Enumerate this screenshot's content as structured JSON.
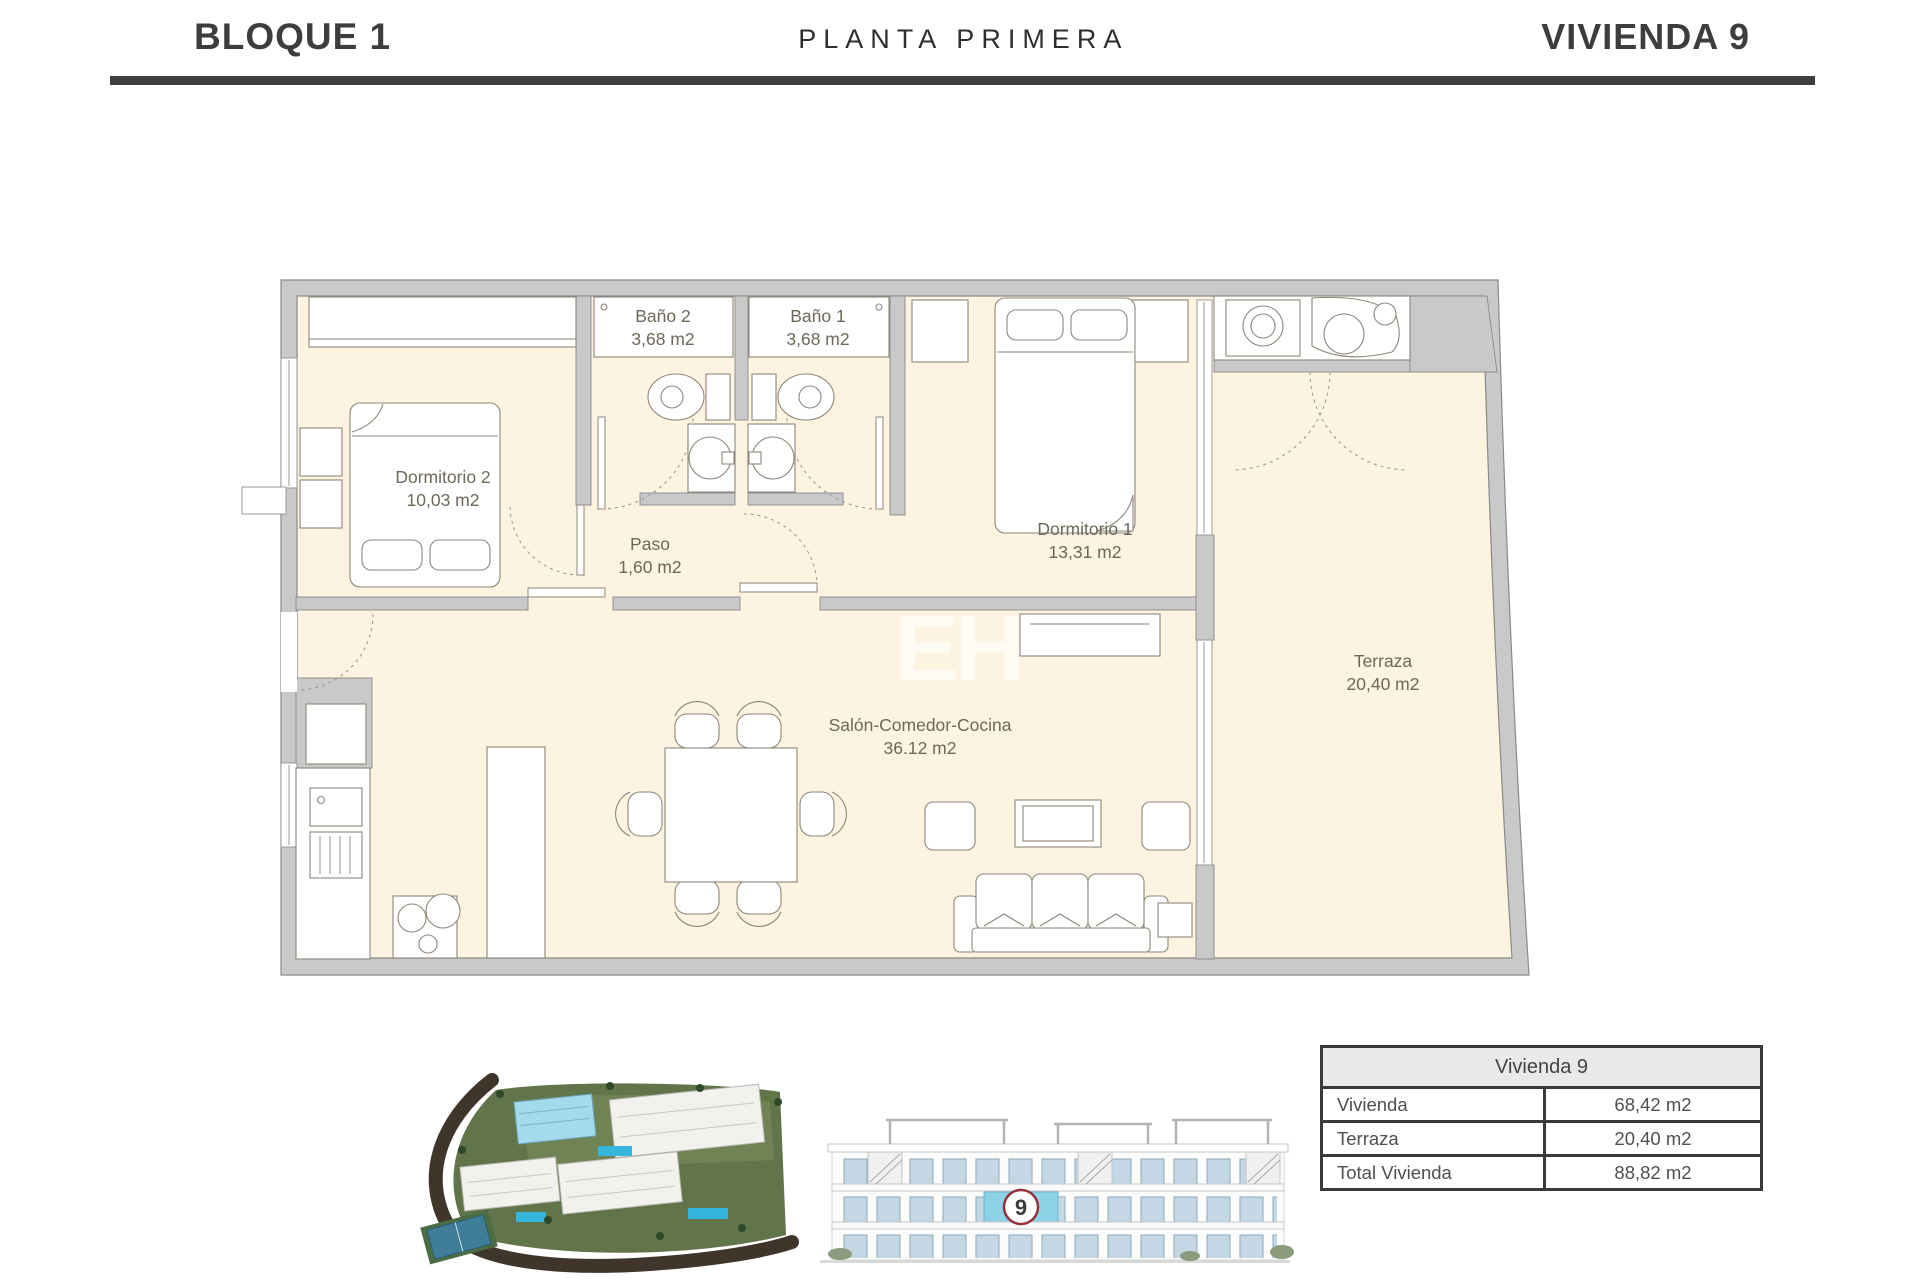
{
  "header": {
    "block": "BLOQUE 1",
    "floor": "PLANTA PRIMERA",
    "unit": "VIVIENDA 9"
  },
  "plan": {
    "watermark": "EH",
    "rooms": [
      {
        "id": "dormitorio2",
        "name": "Dormitorio 2",
        "area": "10,03 m2"
      },
      {
        "id": "bano2",
        "name": "Baño 2",
        "area": "3,68 m2"
      },
      {
        "id": "bano1",
        "name": "Baño 1",
        "area": "3,68 m2"
      },
      {
        "id": "dormitorio1",
        "name": "Dormitorio 1",
        "area": "13,31 m2"
      },
      {
        "id": "paso",
        "name": "Paso",
        "area": "1,60 m2"
      },
      {
        "id": "salon",
        "name": "Salón-Comedor-Cocina",
        "area": "36.12 m2"
      },
      {
        "id": "terraza",
        "name": "Terraza",
        "area": "20,40 m2"
      }
    ]
  },
  "summary_table": {
    "header": "Vivienda 9",
    "rows": [
      {
        "label": "Vivienda",
        "value": "68,42 m2"
      },
      {
        "label": "Terraza",
        "value": "20,40 m2"
      },
      {
        "label": "Total Vivienda",
        "value": "88,82 m2"
      }
    ]
  },
  "elevation": {
    "unit_badge": "9"
  },
  "colors": {
    "floor_cream": "#fcf3e1",
    "wall_gray": "#c9c9c9",
    "highlight_blue": "#8ed2e8",
    "badge_ring": "#93323c",
    "divider_dark": "#3f3f3f",
    "label_text": "#6e6859"
  }
}
